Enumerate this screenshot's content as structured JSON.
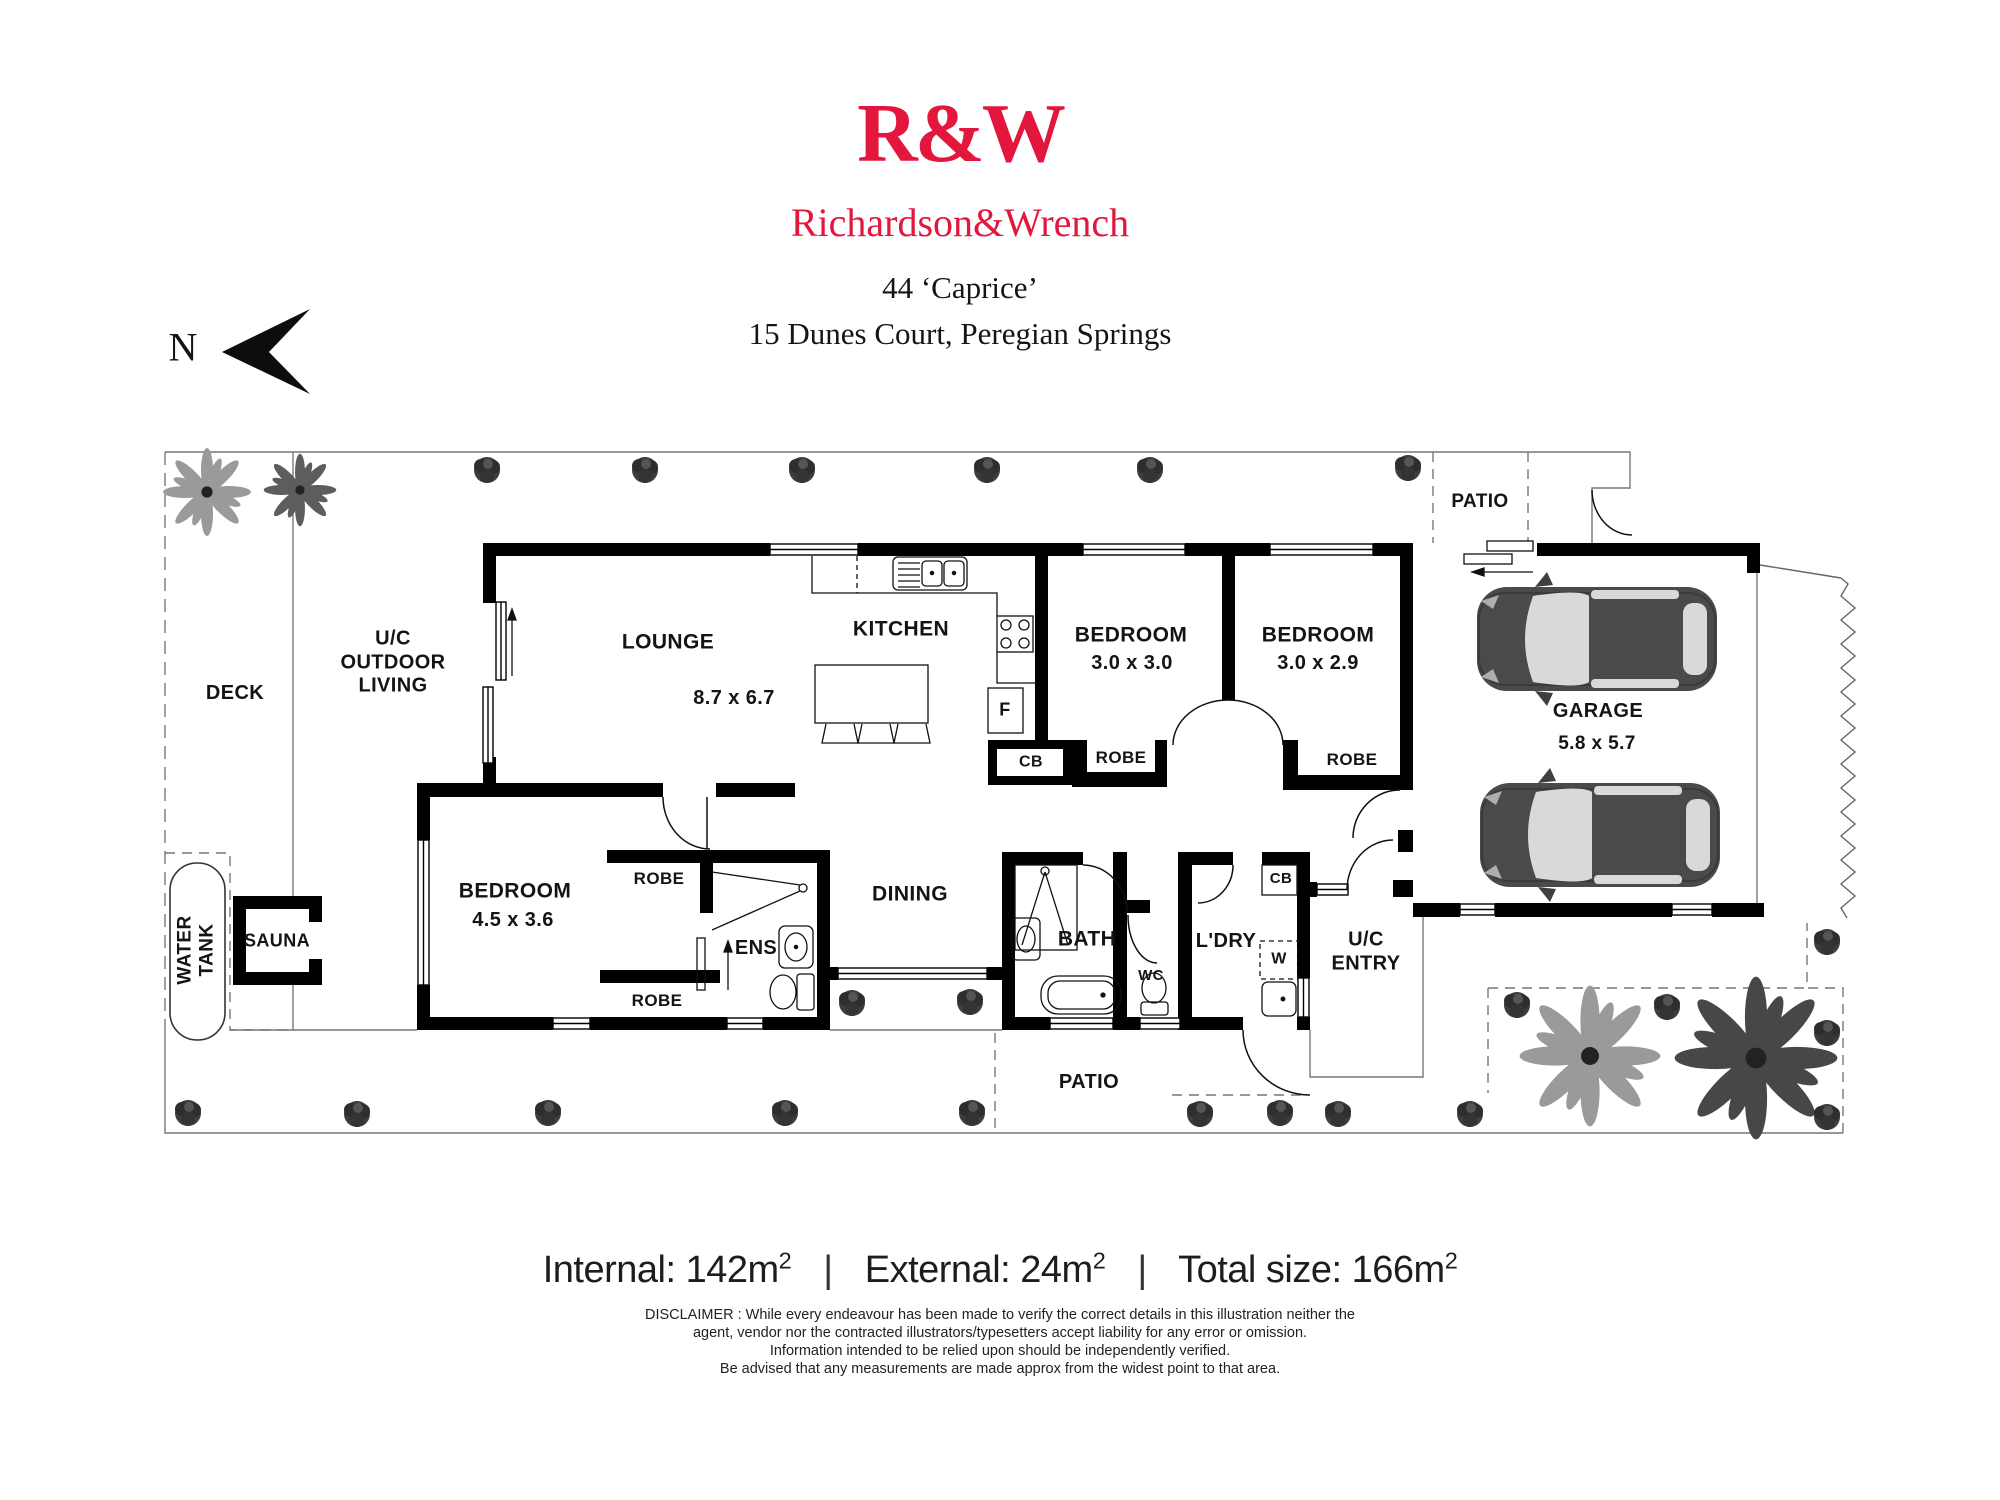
{
  "colors": {
    "brand_red": "#E3173D",
    "wall": "#000000"
  },
  "brand": {
    "logo_text": "R&W",
    "name": "Richardson&Wrench"
  },
  "listing": {
    "line1": "44 ‘Caprice’",
    "line2": "15 Dunes Court, Peregian Springs"
  },
  "compass": {
    "label": "N"
  },
  "rooms": {
    "deck": "DECK",
    "outdoor_living": "U/C\nOUTDOOR\nLIVING",
    "lounge": {
      "label": "LOUNGE",
      "dims": "8.7 x 6.7"
    },
    "kitchen": "KITCHEN",
    "bedroom1": {
      "label": "BEDROOM",
      "dims": "3.0 x 3.0"
    },
    "bedroom2": {
      "label": "BEDROOM",
      "dims": "3.0 x 2.9"
    },
    "bedroom3": {
      "label": "BEDROOM",
      "dims": "4.5 x 3.6"
    },
    "garage": {
      "label": "GARAGE",
      "dims": "5.8 x 5.7"
    },
    "patio": "PATIO",
    "dining": "DINING",
    "bath": "BATH",
    "ens": "ENS",
    "wc": "WC",
    "laundry": "L'DRY",
    "entry": "U/C\nENTRY",
    "sauna": "SAUNA",
    "water_tank": "WATER\nTANK",
    "robe": "ROBE",
    "cb": "CB",
    "fridge": "F",
    "washer": "W"
  },
  "areas": {
    "items": [
      {
        "text": "Internal: 142m",
        "sup": "2"
      },
      {
        "text": "External: 24m",
        "sup": "2"
      },
      {
        "text": "Total size: 166m",
        "sup": "2"
      }
    ],
    "sep": "|"
  },
  "disclaimer": {
    "lines": [
      "DISCLAIMER : While every endeavour has been made to verify the correct details in this illustration neither the",
      "agent, vendor nor the contracted illustrators/typesetters accept liability for any error or omission.",
      "Information intended to be relied upon should be independently verified.",
      "Be advised that any measurements are made approx from the widest point to that area."
    ]
  }
}
